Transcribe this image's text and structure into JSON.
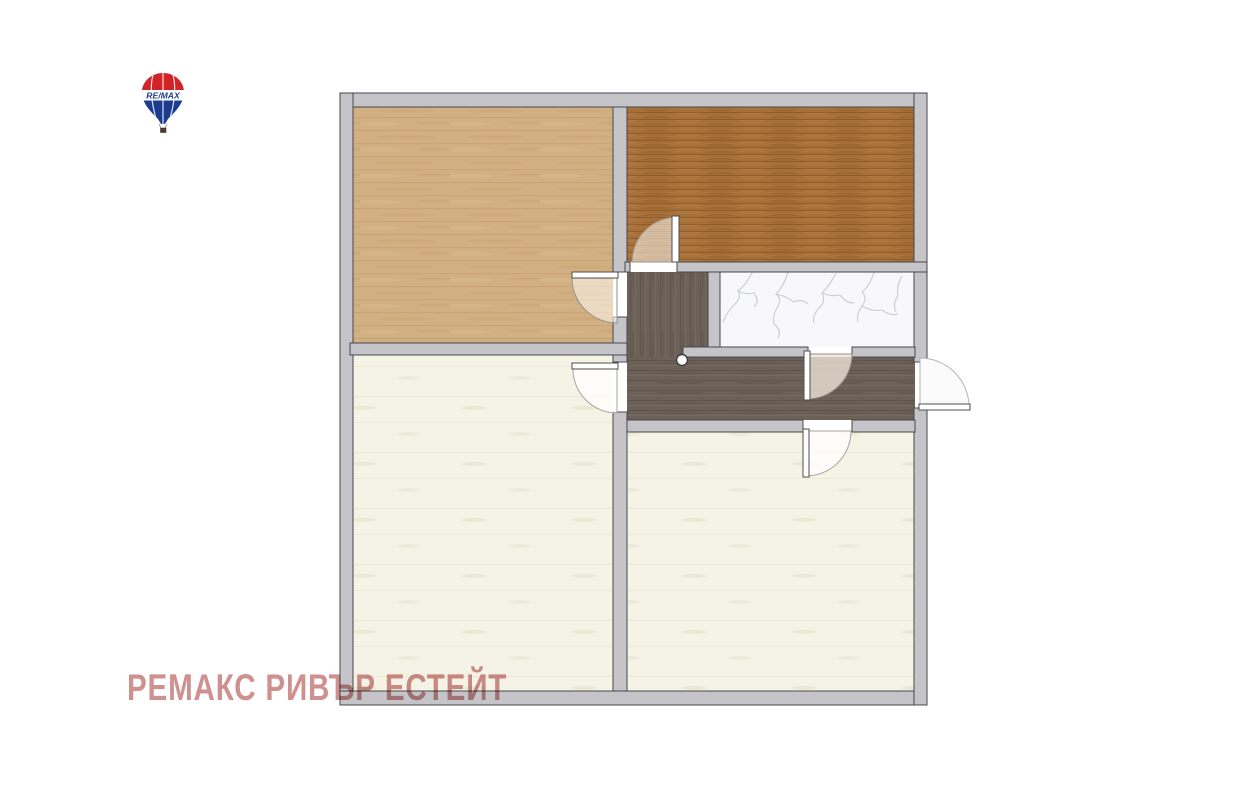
{
  "watermark": {
    "text": "РЕМАКС РИВЪР ЕСТЕЙТ"
  },
  "logo": {
    "label": "RE/MAX"
  },
  "colors": {
    "wall": "#c5c5c9",
    "wall_outline": "#47474b",
    "floor_light_wood": "#d2b083",
    "floor_dark_wood": "#a56f37",
    "floor_corridor": "#6c6157",
    "floor_cream": "#f5f3e6",
    "floor_marble": "#f8f8fa",
    "marble_vein": "#c3c8d1",
    "watermark": "#c98181",
    "logo_red": "#d22328",
    "logo_blue": "#1c3d8f"
  }
}
